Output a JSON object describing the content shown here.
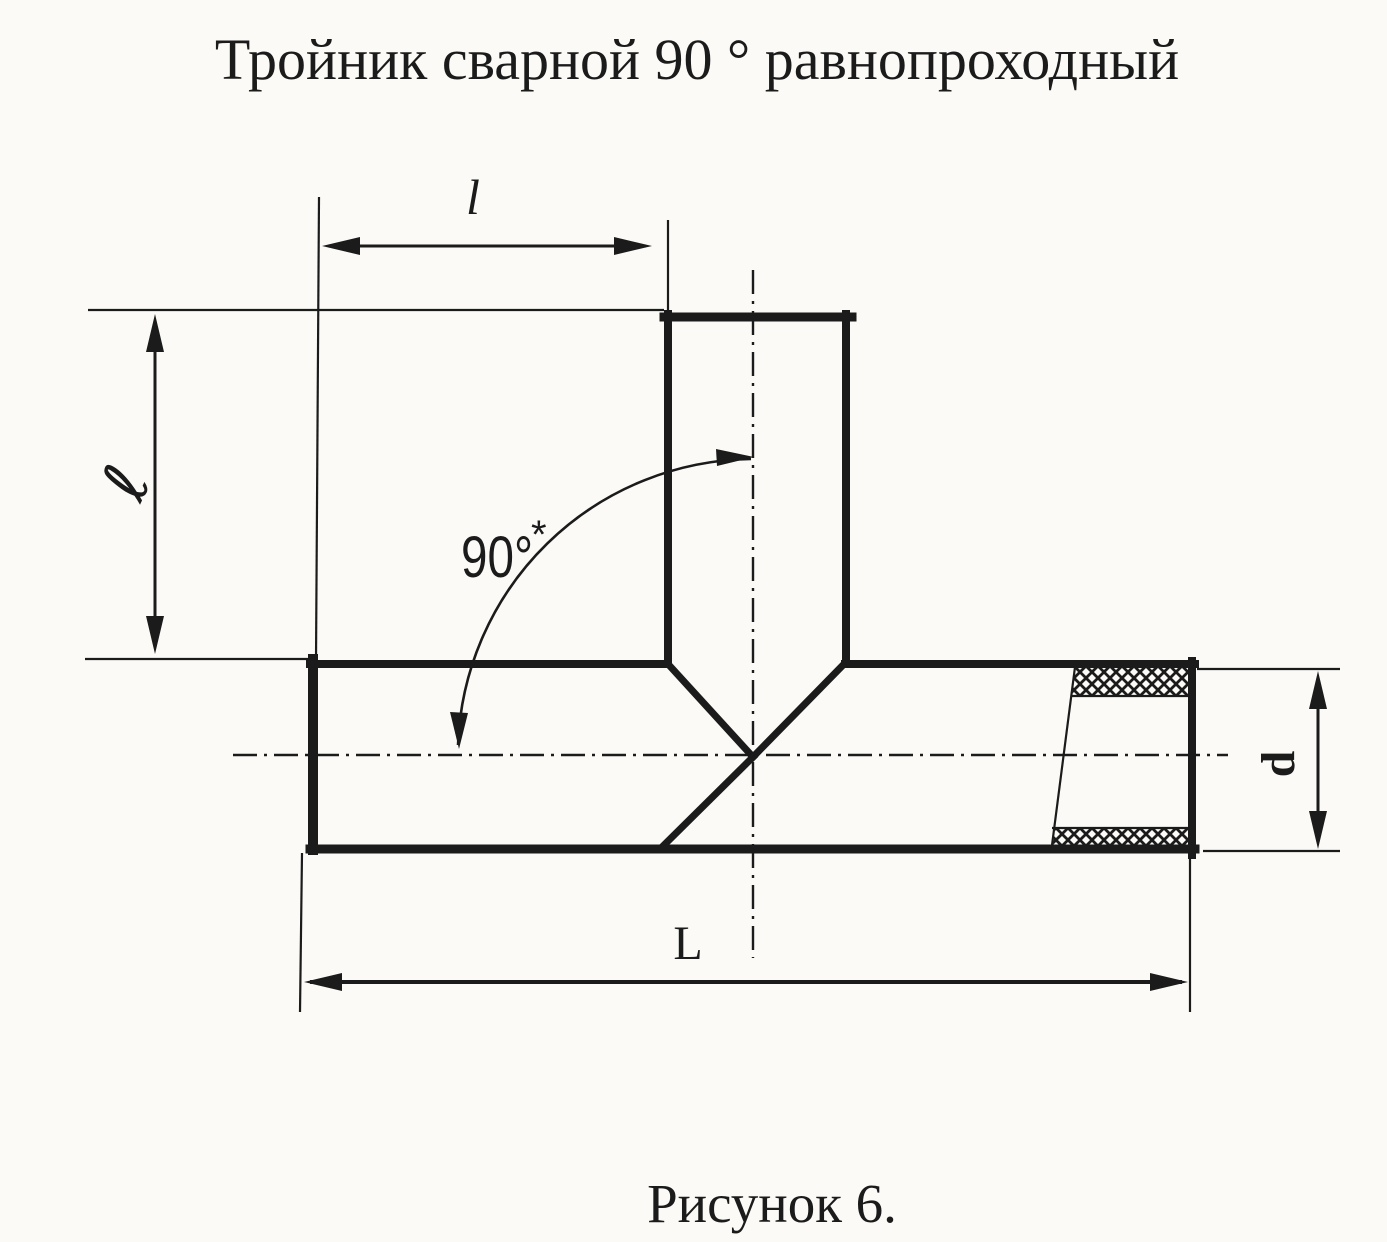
{
  "title": "Тройник сварной 90 ° равнопроходный",
  "caption": "Рисунок 6.",
  "labels": {
    "branch_offset": "l",
    "branch_height": "ℓ",
    "overall_length": "L",
    "diameter": "d",
    "angle": "90°",
    "angle_footnote": "*"
  },
  "colors": {
    "ink": "#1b1b1b",
    "paper": "#fbfaf7"
  }
}
